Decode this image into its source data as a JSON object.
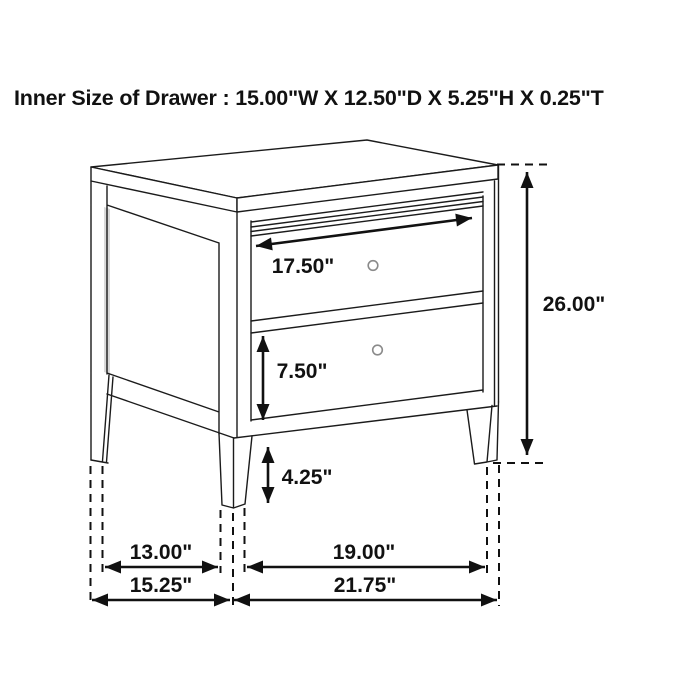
{
  "title": "Inner Size of Drawer : 15.00\"W X 12.50\"D X 5.25\"H X 0.25\"T",
  "labels": {
    "drawer_width": "17.50\"",
    "overall_height": "26.00\"",
    "drawer_front_height": "7.50\"",
    "leg_clearance": "4.25\"",
    "side_depth_inner": "13.00\"",
    "front_width_inner": "19.00\"",
    "overall_depth": "15.25\"",
    "overall_width": "21.75\""
  }
}
